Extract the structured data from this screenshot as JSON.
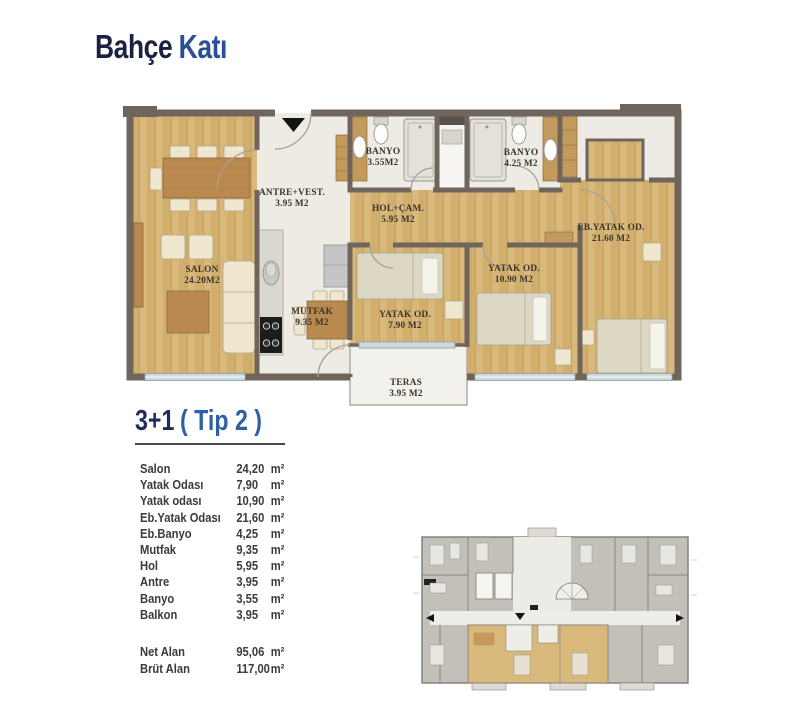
{
  "page": {
    "title_primary": "Bahçe",
    "title_secondary": "Katı"
  },
  "unit": {
    "type_label": "3+1",
    "type_variant": "( Tip 2 )"
  },
  "floor_plan": {
    "rooms": [
      {
        "name": "SALON",
        "area": "24.20M2"
      },
      {
        "name": "ANTRE+VEST.",
        "area": "3.95 M2"
      },
      {
        "name": "BANYO",
        "area": "3.55M2"
      },
      {
        "name": "BANYO",
        "area": "4.25 M2"
      },
      {
        "name": "HOL+ÇAM.",
        "area": "5.95 M2"
      },
      {
        "name": "EB.YATAK OD.",
        "area": "21.60 M2"
      },
      {
        "name": "MUTFAK",
        "area": "9.35 M2"
      },
      {
        "name": "YATAK OD.",
        "area": "7.90 M2"
      },
      {
        "name": "YATAK OD.",
        "area": "10.90 M2"
      },
      {
        "name": "TERAS",
        "area": "3.95 M2"
      }
    ]
  },
  "areas": {
    "rows": [
      {
        "label": "Salon",
        "value": "24,20",
        "unit": "m²"
      },
      {
        "label": "Yatak Odası",
        "value": "7,90",
        "unit": "m²"
      },
      {
        "label": "Yatak odası",
        "value": "10,90",
        "unit": "m²"
      },
      {
        "label": "Eb.Yatak Odası",
        "value": "21,60",
        "unit": "m²"
      },
      {
        "label": "Eb.Banyo",
        "value": "4,25",
        "unit": "m²"
      },
      {
        "label": "Mutfak",
        "value": "9,35",
        "unit": "m²"
      },
      {
        "label": "Hol",
        "value": "5,95",
        "unit": "m²"
      },
      {
        "label": "Antre",
        "value": "3,95",
        "unit": "m²"
      },
      {
        "label": "Banyo",
        "value": "3,55",
        "unit": "m²"
      },
      {
        "label": "Balkon",
        "value": "3,95",
        "unit": "m²"
      }
    ],
    "totals": [
      {
        "label": "Net Alan",
        "value": "95,06",
        "unit": "m²"
      },
      {
        "label": "Brüt Alan",
        "value": "117,00",
        "unit": "m²"
      }
    ]
  },
  "colors": {
    "accent_navy": "#1f2d5c",
    "accent_blue": "#2f5fa5",
    "wood_floor": "#d9b87c",
    "wall": "#6f655c"
  }
}
